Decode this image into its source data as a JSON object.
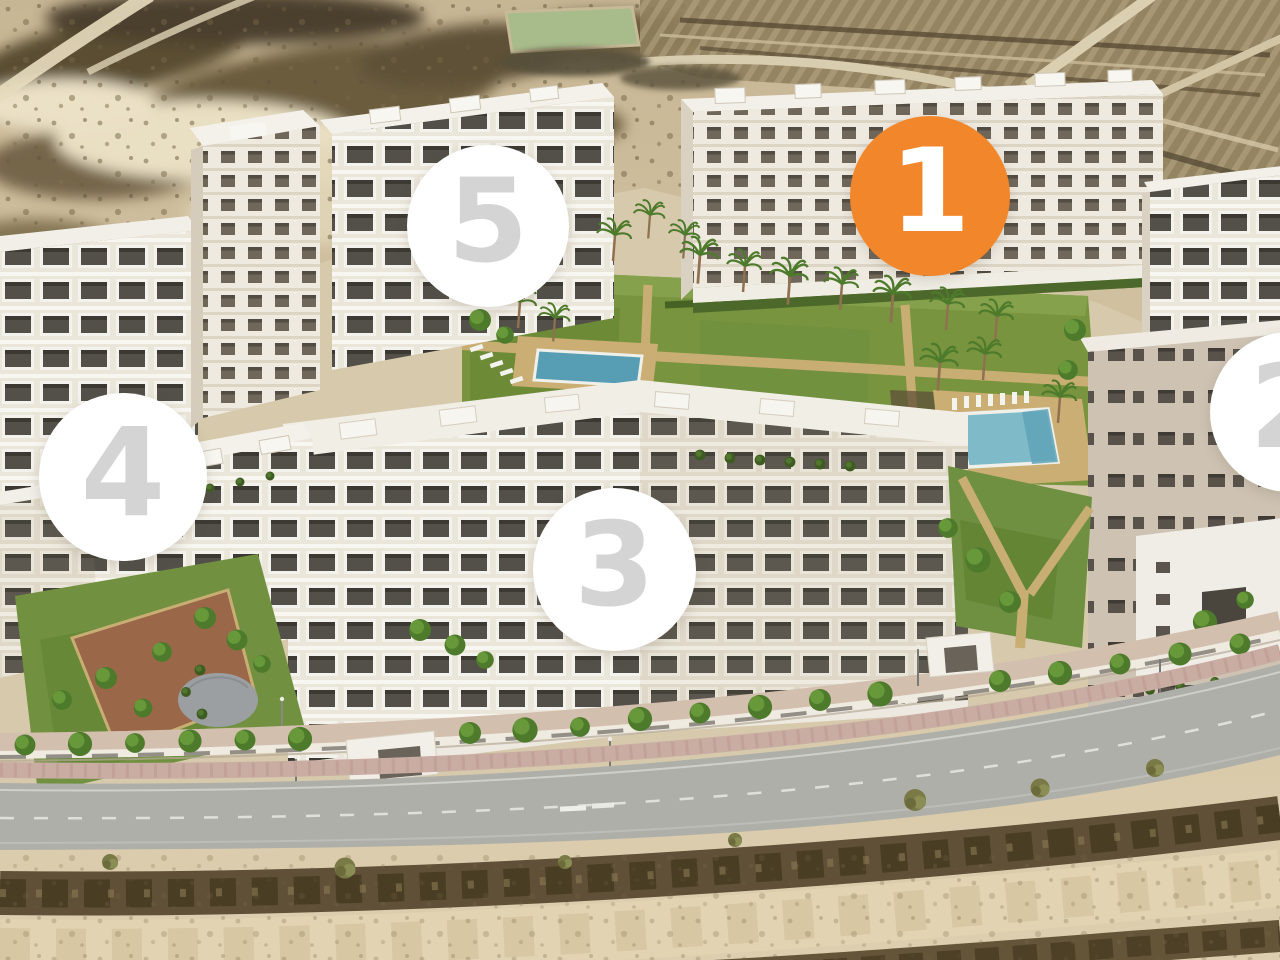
{
  "markers": [
    {
      "label": "1",
      "highlighted": true
    },
    {
      "label": "2",
      "highlighted": false
    },
    {
      "label": "3",
      "highlighted": false
    },
    {
      "label": "4",
      "highlighted": false
    },
    {
      "label": "5",
      "highlighted": false
    }
  ],
  "colors": {
    "marker_highlight_bg": "#F2862B",
    "marker_bg": "#FFFFFF",
    "marker_digit_highlight": "#FFFFFF",
    "marker_digit": "#D4D4D4"
  }
}
